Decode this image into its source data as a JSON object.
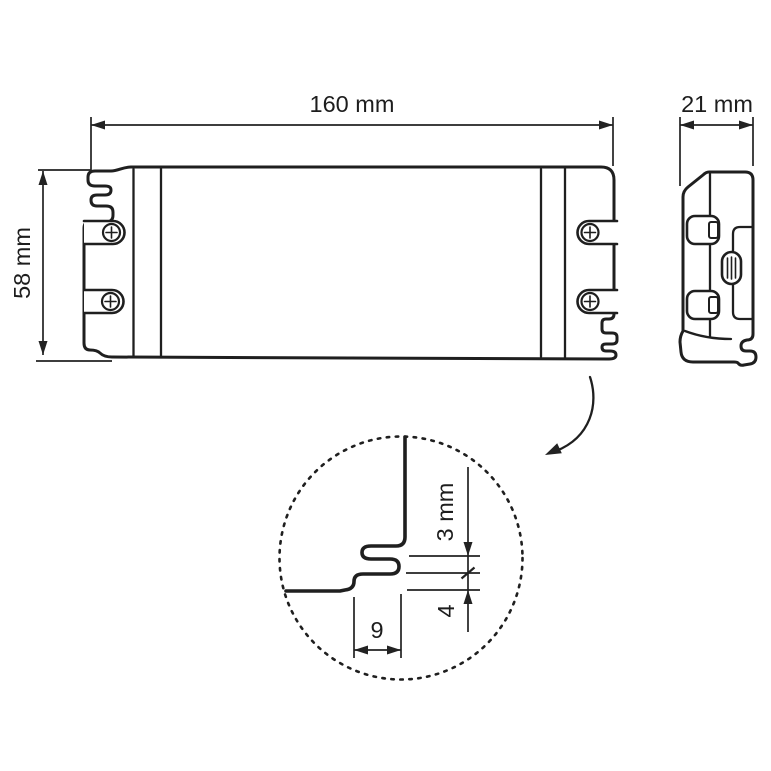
{
  "colors": {
    "line": "#1f1f1f",
    "background": "#ffffff",
    "dimension": "#222222"
  },
  "front_view": {
    "width_label": "160 mm",
    "height_label": "58 mm",
    "screw_count": 4
  },
  "side_view": {
    "width_label": "21 mm"
  },
  "detail_view": {
    "slot_height_label": "3 mm",
    "lip_height_label": "4",
    "hook_width_label": "9"
  }
}
